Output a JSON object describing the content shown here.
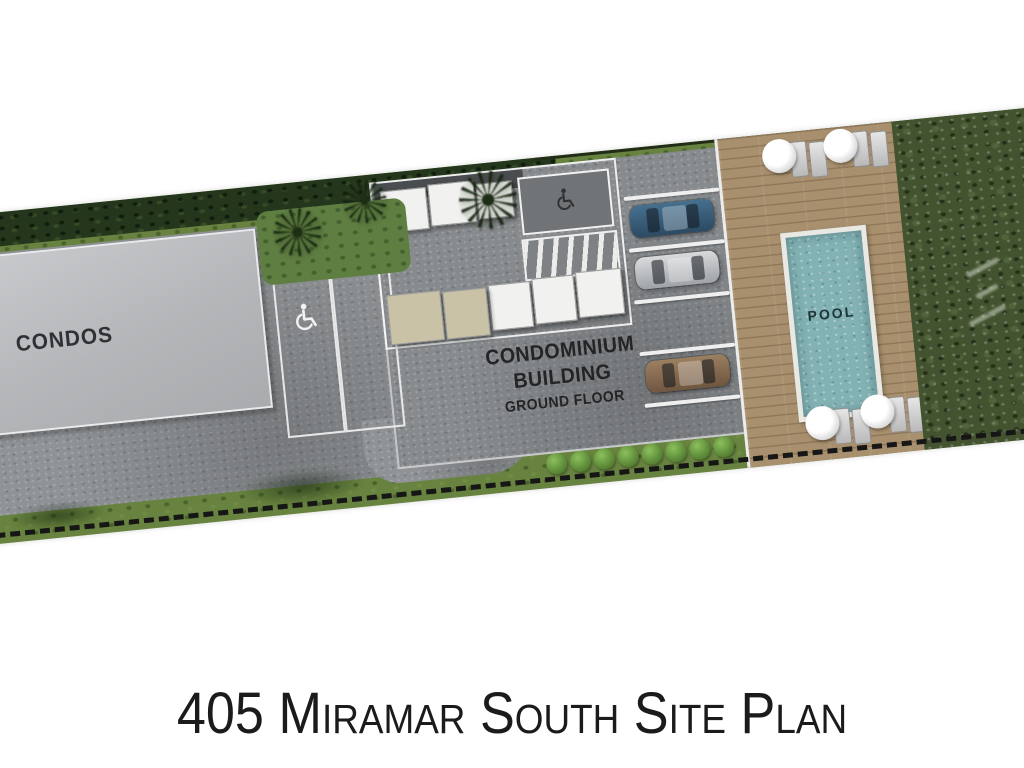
{
  "title": "405 Miramar South Site Plan",
  "site": {
    "labels": {
      "left_building": "CONDOS",
      "center_building_line1": "CONDOMINIUM",
      "center_building_line2": "BUILDING",
      "center_building_line3": "GROUND FLOOR",
      "pool": "POOL"
    },
    "icons": {
      "accessible_parking_icon": "wheelchair",
      "accessible_entry_icon": "wheelchair"
    },
    "parking": {
      "stall_count": 4,
      "stalls": [
        {
          "stall": 1,
          "car": "blue",
          "hex": "#39628a"
        },
        {
          "stall": 2,
          "car": "silver",
          "hex": "#c9cbcd"
        },
        {
          "stall": 3,
          "car": null,
          "hex": null
        },
        {
          "stall": 4,
          "car": "brown",
          "hex": "#8f7457"
        }
      ],
      "accessible_stalls": 2
    },
    "pool_area": {
      "umbrella_lounge_sets": 4,
      "deck_material": "wood"
    },
    "colors": {
      "pool_water": "#83b2b4",
      "deck_wood": "#a8906e",
      "lawn": "#68833f",
      "hedge": "#24371d",
      "pavement": "#8f9396",
      "condos_building": "#c3c5c8",
      "boundary_dash": "#161616",
      "title_text": "#1b1b1b"
    }
  }
}
